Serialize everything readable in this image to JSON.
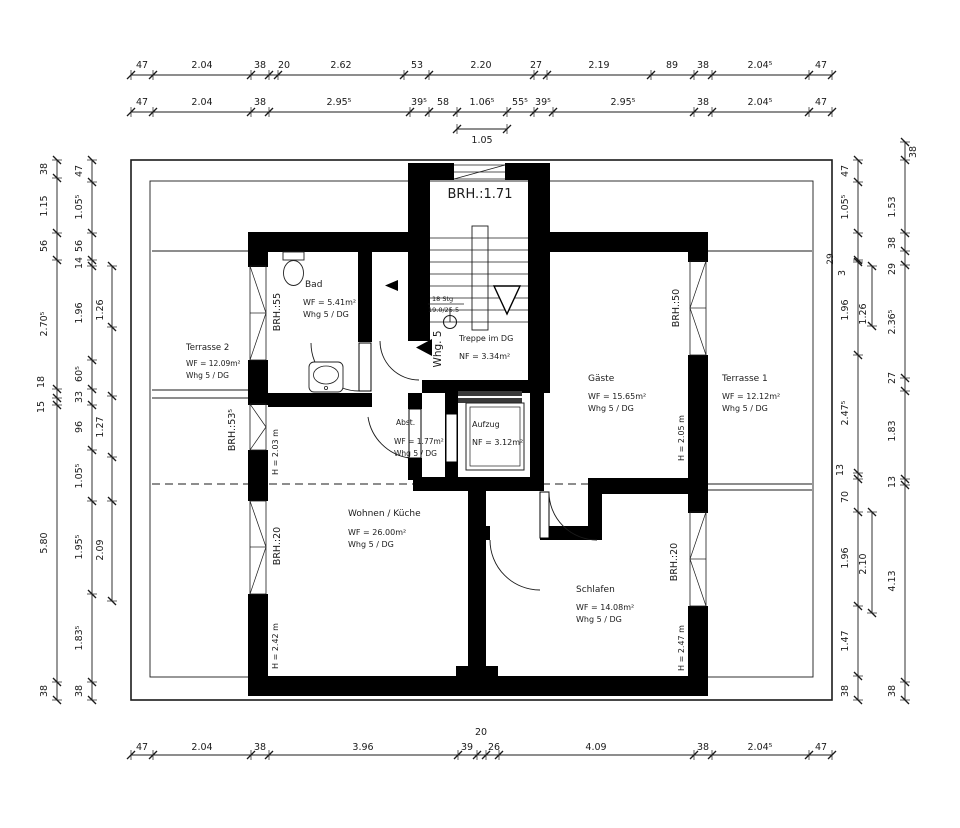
{
  "plan": {
    "texts": [
      {
        "n": "stair-window-sill-label",
        "t": "BRH.:1.71",
        "x": 480,
        "y": 198,
        "s": 13,
        "a": "middle"
      },
      {
        "n": "room-bad-name",
        "t": "Bad",
        "x": 305,
        "y": 287,
        "s": 9
      },
      {
        "n": "room-bad-area",
        "t": "WF = 5.41m²",
        "x": 303,
        "y": 305,
        "s": 8
      },
      {
        "n": "room-bad-unit",
        "t": "Whg 5 / DG",
        "x": 303,
        "y": 317,
        "s": 8
      },
      {
        "n": "room-terrasse2-name",
        "t": "Terrasse 2",
        "x": 186,
        "y": 350,
        "s": 8.5
      },
      {
        "n": "room-terrasse2-area",
        "t": "WF = 12.09m²",
        "x": 186,
        "y": 366,
        "s": 7.5
      },
      {
        "n": "room-terrasse2-unit",
        "t": "Whg 5 / DG",
        "x": 186,
        "y": 378,
        "s": 7.5
      },
      {
        "n": "room-treppe-name",
        "t": "Treppe im DG",
        "x": 459,
        "y": 341,
        "s": 8
      },
      {
        "n": "room-treppe-area",
        "t": "NF = 3.34m²",
        "x": 459,
        "y": 359,
        "s": 8
      },
      {
        "n": "stair-count-note",
        "t": "18 Stg",
        "x": 432,
        "y": 301,
        "s": 6.5
      },
      {
        "n": "stair-ratio-note",
        "t": "19.0/25.5",
        "x": 428,
        "y": 312,
        "s": 6.5
      },
      {
        "n": "apartment-entry-label",
        "t": "Whg. 5",
        "x": 441,
        "y": 349,
        "r": -90,
        "s": 10.5,
        "a": "middle"
      },
      {
        "n": "room-abst-name",
        "t": "Abst.",
        "x": 396,
        "y": 425,
        "s": 7.5
      },
      {
        "n": "room-abst-area",
        "t": "WF = 1.77m²",
        "x": 394,
        "y": 444,
        "s": 7.5
      },
      {
        "n": "room-abst-unit",
        "t": "Whg 5 / DG",
        "x": 394,
        "y": 456,
        "s": 7.5
      },
      {
        "n": "room-aufzug-name",
        "t": "Aufzug",
        "x": 472,
        "y": 427,
        "s": 8
      },
      {
        "n": "room-aufzug-area",
        "t": "NF = 3.12m²",
        "x": 472,
        "y": 445,
        "s": 8
      },
      {
        "n": "room-gaeste-name",
        "t": "Gäste",
        "x": 588,
        "y": 381,
        "s": 9
      },
      {
        "n": "room-gaeste-area",
        "t": "WF = 15.65m²",
        "x": 588,
        "y": 399,
        "s": 8
      },
      {
        "n": "room-gaeste-unit",
        "t": "Whg 5 / DG",
        "x": 588,
        "y": 411,
        "s": 8
      },
      {
        "n": "room-terrasse1-name",
        "t": "Terrasse 1",
        "x": 722,
        "y": 381,
        "s": 9
      },
      {
        "n": "room-terrasse1-area",
        "t": "WF = 12.12m²",
        "x": 722,
        "y": 399,
        "s": 8
      },
      {
        "n": "room-terrasse1-unit",
        "t": "Whg 5 / DG",
        "x": 722,
        "y": 411,
        "s": 8
      },
      {
        "n": "room-wohnen-name",
        "t": "Wohnen / Küche",
        "x": 348,
        "y": 516,
        "s": 9
      },
      {
        "n": "room-wohnen-area",
        "t": "WF = 26.00m²",
        "x": 348,
        "y": 535,
        "s": 8
      },
      {
        "n": "room-wohnen-unit",
        "t": "Whg 5 / DG",
        "x": 348,
        "y": 547,
        "s": 8
      },
      {
        "n": "room-schlafen-name",
        "t": "Schlafen",
        "x": 576,
        "y": 592,
        "s": 9
      },
      {
        "n": "room-schlafen-area",
        "t": "WF = 14.08m²",
        "x": 576,
        "y": 610,
        "s": 8
      },
      {
        "n": "room-schlafen-unit",
        "t": "Whg 5 / DG",
        "x": 576,
        "y": 622,
        "s": 8
      },
      {
        "n": "height-label-terrasse2",
        "t": "H = 2.03 m",
        "x": 278,
        "y": 452,
        "r": -90,
        "s": 8,
        "a": "middle"
      },
      {
        "n": "height-label-wohnen",
        "t": "H = 2.42 m",
        "x": 278,
        "y": 646,
        "r": -90,
        "s": 8,
        "a": "middle"
      },
      {
        "n": "height-label-gaeste",
        "t": "H = 2.05 m",
        "x": 684,
        "y": 438,
        "r": -90,
        "s": 8,
        "a": "middle"
      },
      {
        "n": "height-label-schlafen",
        "t": "H = 2.47 m",
        "x": 684,
        "y": 648,
        "r": -90,
        "s": 8,
        "a": "middle"
      },
      {
        "n": "sill-label-bad",
        "t": "BRH.:55",
        "x": 280,
        "y": 312,
        "r": -90,
        "s": 9.5,
        "a": "middle"
      },
      {
        "n": "sill-label-west2",
        "t": "BRH.:53⁵",
        "x": 235,
        "y": 430,
        "r": -90,
        "s": 9.5,
        "a": "middle"
      },
      {
        "n": "sill-label-wohnen",
        "t": "BRH.:20",
        "x": 280,
        "y": 546,
        "r": -90,
        "s": 9.5,
        "a": "middle"
      },
      {
        "n": "sill-label-gaeste",
        "t": "BRH.:50",
        "x": 679,
        "y": 308,
        "r": -90,
        "s": 9.5,
        "a": "middle"
      },
      {
        "n": "sill-label-schlafen",
        "t": "BRH.:20",
        "x": 677,
        "y": 562,
        "r": -90,
        "s": 9.5,
        "a": "middle"
      },
      {
        "n": "dim-corner-29",
        "t": "29",
        "x": 833,
        "y": 259,
        "r": -90,
        "s": 9,
        "a": "middle"
      }
    ],
    "chains": [
      {
        "n": "top-row1",
        "o": "h",
        "p": 75,
        "f": 131,
        "t": 832,
        "ticks": [
          131,
          153,
          251,
          269,
          278,
          404,
          429,
          534,
          547,
          651,
          694,
          712,
          809,
          832
        ],
        "labels": [
          [
            "47",
            142,
            68
          ],
          [
            "2.04",
            202,
            68
          ],
          [
            "38",
            260,
            68
          ],
          [
            "20",
            284,
            68
          ],
          [
            "2.62",
            341,
            68
          ],
          [
            "53",
            417,
            68
          ],
          [
            "2.20",
            481,
            68
          ],
          [
            "27",
            536,
            68
          ],
          [
            "2.19",
            599,
            68
          ],
          [
            "89",
            672,
            68
          ],
          [
            "38",
            703,
            68
          ],
          [
            "2.04⁵",
            760,
            68
          ],
          [
            "47",
            821,
            68
          ]
        ]
      },
      {
        "n": "top-row2",
        "o": "h",
        "p": 112,
        "f": 131,
        "t": 832,
        "ticks": [
          131,
          153,
          251,
          269,
          410,
          429,
          457,
          507,
          534,
          553,
          694,
          712,
          809,
          832
        ],
        "labels": [
          [
            "47",
            142,
            105
          ],
          [
            "2.04",
            202,
            105
          ],
          [
            "38",
            260,
            105
          ],
          [
            "2.95⁵",
            339,
            105
          ],
          [
            "39⁵",
            419,
            105
          ],
          [
            "58",
            443,
            105
          ],
          [
            "1.06⁵",
            482,
            105
          ],
          [
            "55⁵",
            520,
            105
          ],
          [
            "39⁵",
            543,
            105
          ],
          [
            "2.95⁵",
            623,
            105
          ],
          [
            "38",
            703,
            105
          ],
          [
            "2.04⁵",
            760,
            105
          ],
          [
            "47",
            821,
            105
          ]
        ]
      },
      {
        "n": "top-sub",
        "o": "h",
        "p": 129,
        "f": 457,
        "t": 507,
        "ticks": [
          457,
          507
        ],
        "labels": [
          [
            "1.05",
            482,
            143
          ]
        ]
      },
      {
        "n": "bottom",
        "o": "h",
        "p": 755,
        "f": 131,
        "t": 832,
        "ticks": [
          131,
          153,
          251,
          269,
          458,
          477,
          486,
          499,
          694,
          712,
          809,
          832
        ],
        "labels": [
          [
            "47",
            142,
            750
          ],
          [
            "2.04",
            202,
            750
          ],
          [
            "38",
            260,
            750
          ],
          [
            "3.96",
            363,
            750
          ],
          [
            "39",
            467,
            750
          ],
          [
            "20",
            481,
            735
          ],
          [
            "26",
            494,
            750
          ],
          [
            "4.09",
            596,
            750
          ],
          [
            "38",
            703,
            750
          ],
          [
            "2.04⁵",
            760,
            750
          ],
          [
            "47",
            821,
            750
          ]
        ]
      },
      {
        "n": "left-outer",
        "o": "v",
        "p": 57,
        "f": 160,
        "t": 700,
        "ticks": [
          160,
          178,
          233,
          260,
          389,
          398,
          405,
          682,
          700
        ],
        "labels": [
          [
            "38",
            47,
            169
          ],
          [
            "1.15",
            47,
            206
          ],
          [
            "56",
            47,
            246
          ],
          [
            "2.70⁵",
            47,
            324
          ],
          [
            "18",
            44,
            382
          ],
          [
            "15",
            44,
            407
          ],
          [
            "5.80",
            47,
            543
          ],
          [
            "38",
            47,
            691
          ]
        ]
      },
      {
        "n": "left-mid",
        "o": "v",
        "p": 92,
        "f": 160,
        "t": 700,
        "ticks": [
          160,
          182,
          233,
          260,
          266,
          360,
          389,
          405,
          450,
          501,
          594,
          682,
          700
        ],
        "labels": [
          [
            "47",
            82,
            171
          ],
          [
            "1.05⁵",
            82,
            207
          ],
          [
            "56",
            82,
            246
          ],
          [
            "14",
            82,
            263
          ],
          [
            "1.96",
            82,
            313
          ],
          [
            "60⁵",
            82,
            374
          ],
          [
            "33",
            82,
            397
          ],
          [
            "96",
            82,
            427
          ],
          [
            "1.05⁵",
            82,
            476
          ],
          [
            "1.95⁵",
            82,
            547
          ],
          [
            "1.83⁵",
            82,
            638
          ],
          [
            "38",
            82,
            691
          ]
        ]
      },
      {
        "n": "left-inner",
        "o": "v",
        "p": 112,
        "f": 266,
        "t": 601,
        "ticks": [
          266,
          327,
          396,
          457,
          501,
          601
        ],
        "labels": [
          [
            "1.26",
            103,
            310
          ],
          [
            "1.27",
            103,
            427
          ],
          [
            "2.09",
            103,
            550
          ]
        ]
      },
      {
        "n": "right-inner",
        "o": "v",
        "p": 858,
        "f": 160,
        "t": 700,
        "ticks": [
          160,
          182,
          233,
          260,
          262,
          355,
          473,
          479,
          512,
          606,
          676,
          700
        ],
        "labels": [
          [
            "47",
            848,
            171
          ],
          [
            "1.05⁵",
            848,
            207
          ],
          [
            "3",
            845,
            273
          ],
          [
            "1.96",
            848,
            310
          ],
          [
            "2.47⁵",
            848,
            413
          ],
          [
            "13",
            843,
            470
          ],
          [
            "70",
            848,
            497
          ],
          [
            "1.96",
            848,
            558
          ],
          [
            "1.47",
            848,
            641
          ],
          [
            "38",
            848,
            691
          ]
        ]
      },
      {
        "n": "right-inner-sub-a",
        "o": "v",
        "p": 872,
        "f": 266,
        "t": 326,
        "ticks": [
          266,
          326
        ],
        "labels": [
          [
            "1.26",
            866,
            314
          ]
        ]
      },
      {
        "n": "right-inner-sub-b",
        "o": "v",
        "p": 872,
        "f": 512,
        "t": 613,
        "ticks": [
          512,
          613
        ],
        "labels": [
          [
            "2.10",
            866,
            564
          ]
        ]
      },
      {
        "n": "right-outer",
        "o": "v",
        "p": 905,
        "f": 142,
        "t": 700,
        "ticks": [
          142,
          160,
          233,
          251,
          265,
          378,
          391,
          479,
          485,
          682,
          700
        ],
        "labels": [
          [
            "38",
            916,
            152
          ],
          [
            "1.53",
            895,
            207
          ],
          [
            "38",
            895,
            243
          ],
          [
            "29",
            895,
            269
          ],
          [
            "2.36⁵",
            895,
            322
          ],
          [
            "27",
            895,
            378
          ],
          [
            "1.83",
            895,
            431
          ],
          [
            "13",
            895,
            482
          ],
          [
            "4.13",
            895,
            581
          ],
          [
            "38",
            895,
            691
          ]
        ]
      }
    ]
  }
}
